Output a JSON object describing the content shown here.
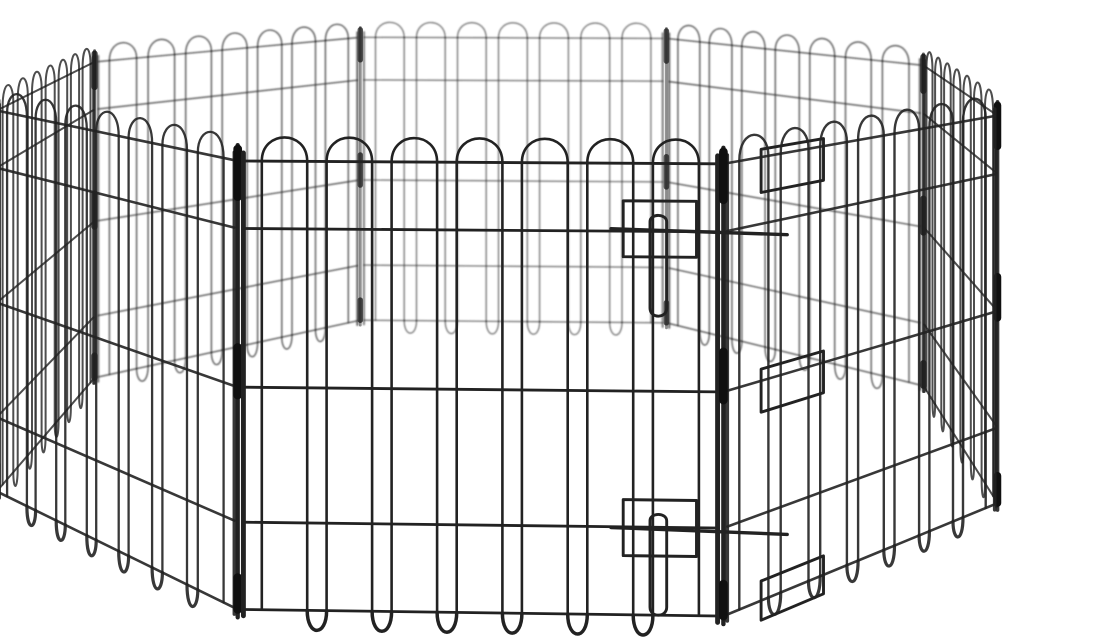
{
  "meta": {
    "alt": "Black wire octagonal pet exercise playpen with rounded loop wire tops and bottoms, corner sleeves, and a front door panel secured by two slide-bolt latches, photographed on a plain white background",
    "background_color": "#ffffff"
  },
  "scene": {
    "subject": "octagonal wire pet exercise pen",
    "panel_count": 8,
    "loops_per_panel": 7,
    "wire_color": "#222222",
    "sleeve_color": "#101010",
    "panel_names": [
      "front-door",
      "front-right",
      "right",
      "back-right",
      "back",
      "back-left",
      "left",
      "front-left"
    ],
    "hardware": [
      "slide-bolt-latch-top",
      "slide-bolt-latch-bottom",
      "hinge-clips",
      "corner-sleeves"
    ]
  },
  "geometry": {
    "canvas": {
      "width": 1100,
      "height": 642
    },
    "octagon_radius": 79.7,
    "rotation_deg": -2,
    "camera": {
      "distance": 324,
      "focal": 1996,
      "height": 100.7,
      "cx": 500,
      "cy0": -174
    },
    "wire_top": 58.5,
    "arc_top": 61.5,
    "wire_bottom": 2,
    "arc_bottom": -0.5,
    "rails": [
      58.5,
      50,
      30,
      13,
      2
    ],
    "stile_inset": 0.012,
    "stile_top": 59.5,
    "stile_bottom": 1.2,
    "wire_margin": 0.03,
    "wire_span": 0.94,
    "pair_offsets": [
      0.15,
      0.85
    ],
    "post_top": 60.5,
    "post_bottom": 1.0,
    "sleeves": [
      [
        60,
        54
      ],
      [
        35,
        29
      ],
      [
        6,
        2
      ]
    ],
    "door_panel_index": 0,
    "latches": [
      {
        "y": 50,
        "bracket_u": [
          0.795,
          0.945
        ],
        "bracket_dy": [
          3.8,
          -3.2
        ],
        "bolt_u": [
          0.77,
          1.13
        ],
        "handle_u": [
          0.85,
          0.884
        ],
        "handle_top": 1.2,
        "handle_bottom": -10.6
      },
      {
        "y": 12.6,
        "bracket_u": [
          0.795,
          0.945
        ],
        "bracket_dy": [
          3.8,
          -3.2
        ],
        "bolt_u": [
          0.77,
          1.13
        ],
        "handle_u": [
          0.85,
          0.884
        ],
        "handle_top": 1.2,
        "handle_bottom": -10.6
      }
    ],
    "clips_panel_index": 1,
    "clips_u": [
      0.12,
      0.33
    ],
    "clips_y": [
      [
        59.5,
        54
      ],
      [
        31.5,
        26
      ],
      [
        4.5,
        -0.5
      ]
    ]
  },
  "style": {
    "width_factor": 640,
    "opacity_base": 1.75,
    "opacity_scale": 330,
    "opacity_min": 0.45,
    "blur_threshold": 360,
    "post_mult": 1.7,
    "sleeve_mult": 3.4,
    "stile_mult": 1.5,
    "door_stile_mult": 1.9,
    "bottom_mult": 1.35,
    "latch_mult": 1.15
  }
}
